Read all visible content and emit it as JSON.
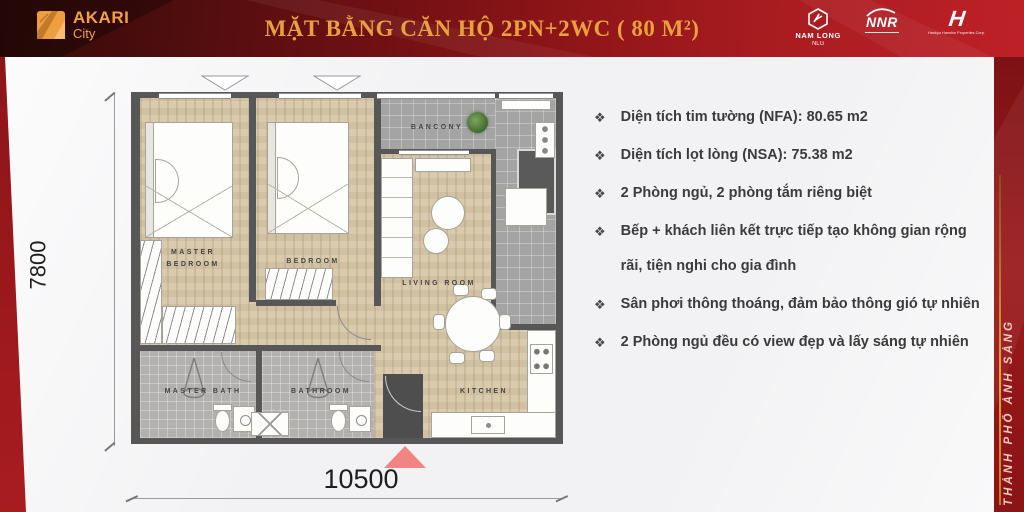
{
  "header": {
    "brand": {
      "name": "AKARI",
      "sub": "City"
    },
    "title": "MẶT BẰNG CĂN HỘ 2PN+2WC ( 80 M²)",
    "partners": [
      {
        "name": "NAM LONG",
        "sub": "NLG"
      },
      {
        "name": "NNR"
      },
      {
        "name": "Hankyu Hanshin Properties Corp.",
        "glyph": "H"
      }
    ]
  },
  "floor_plan": {
    "rooms": {
      "master_bedroom": "MASTER BEDROOM",
      "bedroom": "BEDROOM",
      "living_room": "LIVING ROOM",
      "kitchen": "KITCHEN",
      "master_bath": "MASTER BATH",
      "bathroom": "BATHROOM",
      "balcony": "BANCONY"
    },
    "dimensions": {
      "width": "10500",
      "height": "7800"
    }
  },
  "features": {
    "bullet": "❖",
    "items": [
      "Diện tích tim tường (NFA): 80.65 m2",
      "Diện tích lọt lòng (NSA): 75.38 m2",
      "2 Phòng ngủ, 2 phòng tắm riêng biệt",
      "Bếp + khách liên kết trực tiếp tạo không gian rộng rãi, tiện nghi cho gia đình",
      "Sân phơi thông thoáng, đảm bảo thông gió tự nhiên",
      "2 Phòng ngủ đều có view đẹp và lấy sáng tự nhiên"
    ]
  },
  "side_banner": {
    "text": "THÀNH PHỐ ÁNH SÁNG"
  },
  "colors": {
    "header_red": "#a81c20",
    "header_dark": "#320b0a",
    "title_gold": "#e9a13f",
    "brand_orange": "#f2a044",
    "wood_floor": "#d8c7a8",
    "tile_gray": "#a4a4a4",
    "wall_gray": "#575757",
    "entrance_arrow": "#f28484",
    "banner_text": "#eec9bd",
    "accent_line_orange": "#e8a33d"
  }
}
